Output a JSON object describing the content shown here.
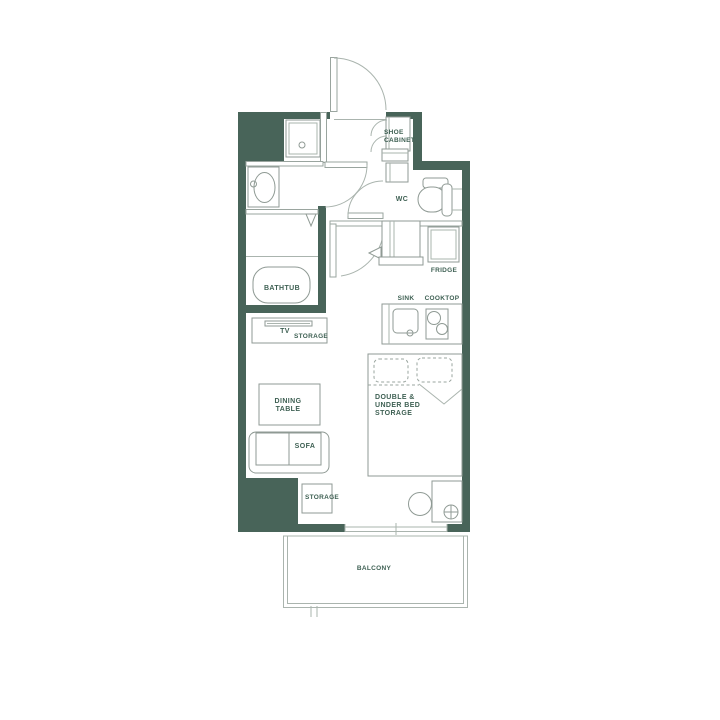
{
  "colors": {
    "wall": "#486459",
    "label": "#3e6053",
    "line_light": "#aab4ae",
    "line_medium": "#8f9a94",
    "background": "#ffffff"
  },
  "labels": {
    "shoe_cabinet_line1": "SHOE",
    "shoe_cabinet_line2": "CABINET",
    "wc": "WC",
    "fridge": "FRIDGE",
    "sink": "SINK",
    "cooktop": "COOKTOP",
    "bathtub": "BATHTUB",
    "tv": "TV",
    "tv_storage": "STORAGE",
    "dining_line1": "DINING",
    "dining_line2": "TABLE",
    "sofa": "SOFA",
    "bed_line1": "DOUBLE &",
    "bed_line2": "UNDER BED",
    "bed_line3": "STORAGE",
    "storage": "STORAGE",
    "balcony": "BALCONY"
  }
}
